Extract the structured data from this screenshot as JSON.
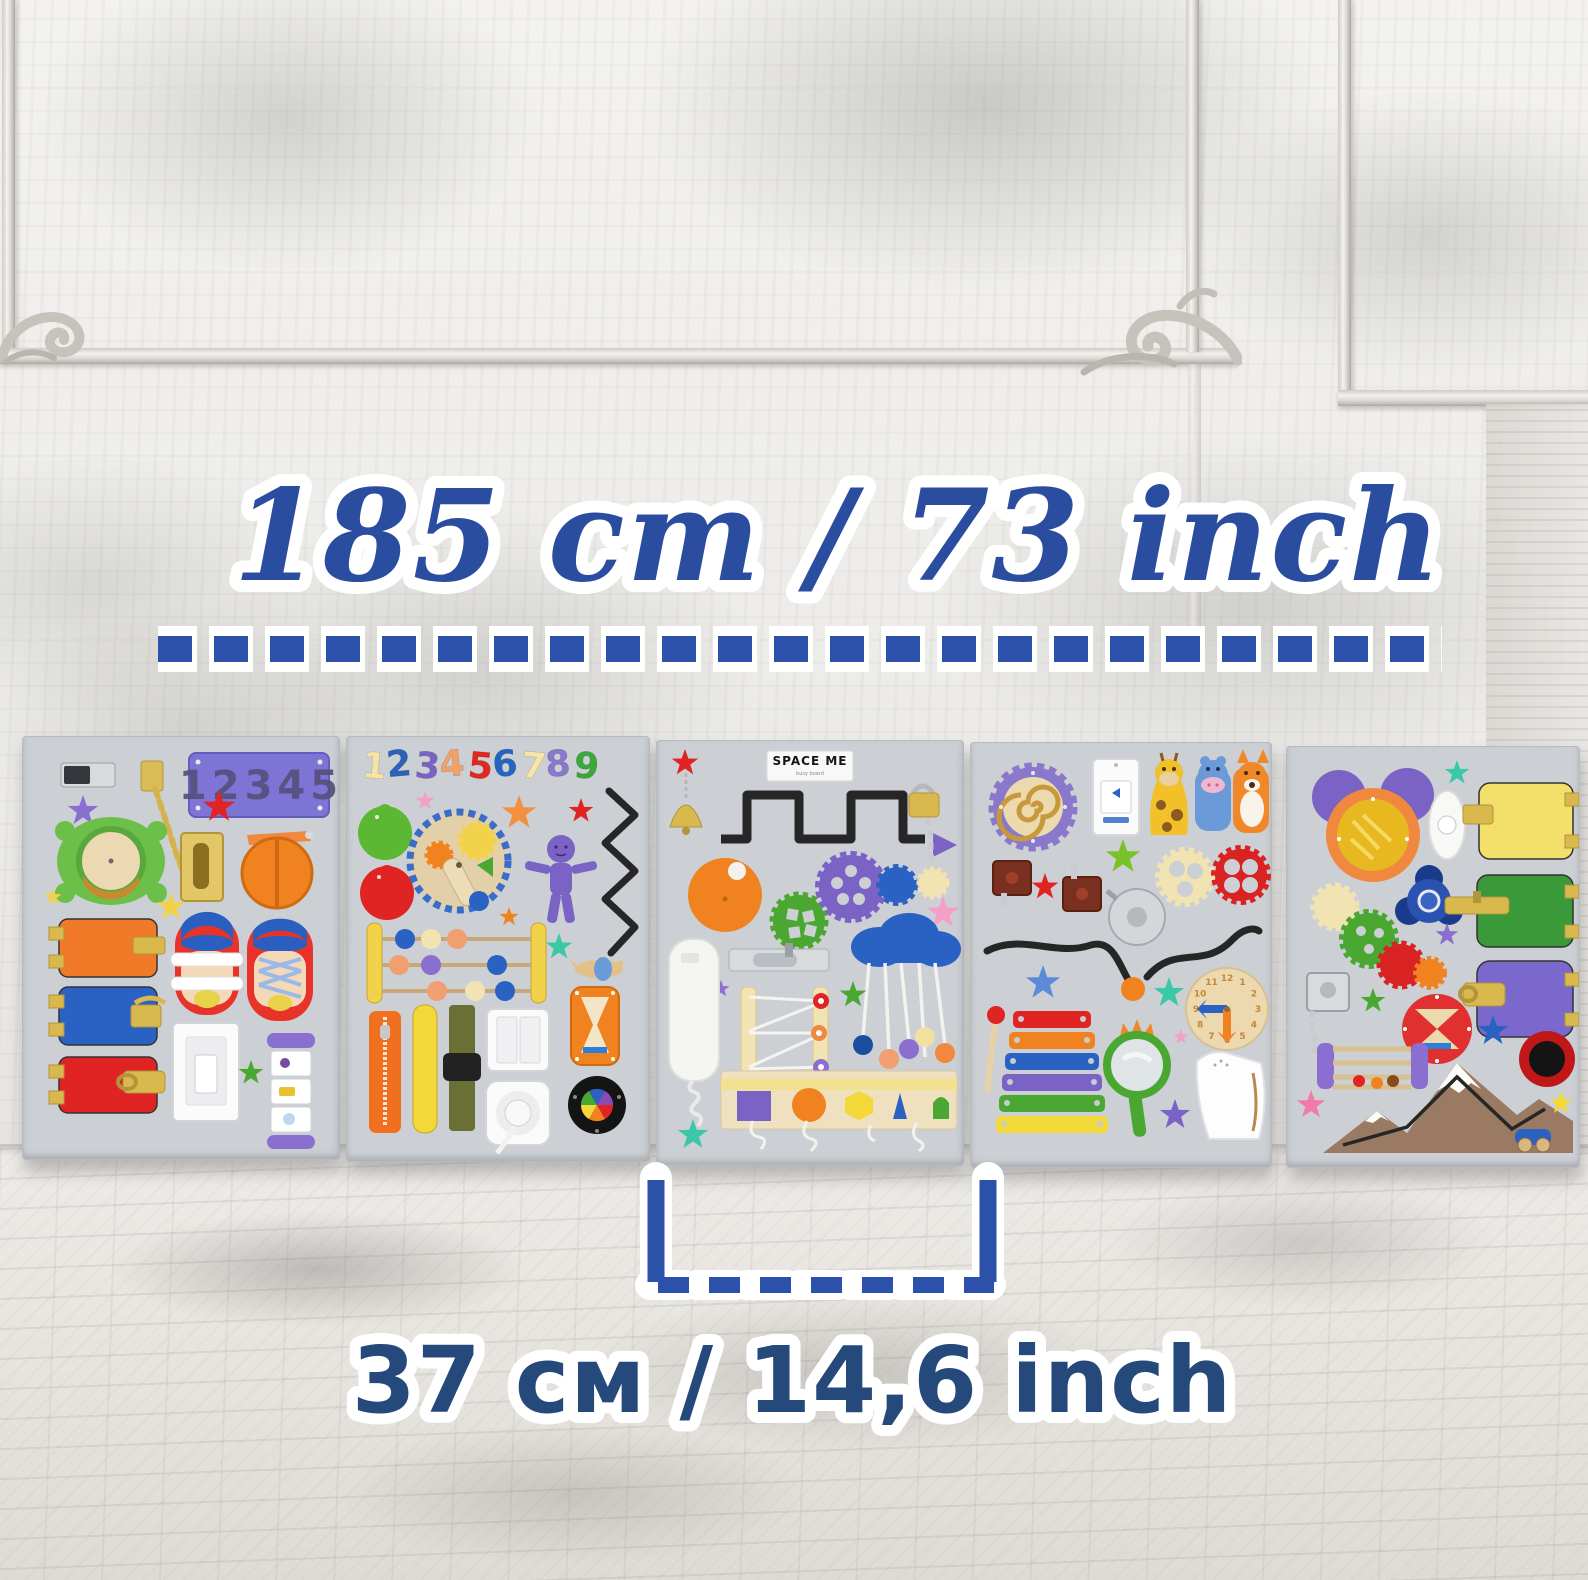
{
  "annotations": {
    "length_label": "185 cm  /  73 inch",
    "width_label": "37 см / 14,6 inch",
    "length_color": "#2b4da0",
    "width_color": "#26497c",
    "dash_color": "#2b51ab"
  },
  "palette": {
    "board_gray": "#ccd0d4",
    "wall_white": "#efeeec",
    "floor_wood": "#e7e4e0",
    "brass": "#d9b84e",
    "chrome": "#d8dadc"
  },
  "boards": [
    {
      "id": "board-1",
      "plaque_number": "12345",
      "items": [
        "chrome-slide-latch",
        "purple-star",
        "number-plaque",
        "door-chain-lock",
        "turtle-sand-window",
        "door-guard-latch",
        "orange-spinning-wheel",
        "yellow-stars",
        "orange-door-with-latch",
        "velcro-sandal",
        "lace-up-sneaker",
        "blue-door-with-hook",
        "red-door-with-hasp",
        "light-switch",
        "picture-cube-spinner",
        "green-star"
      ]
    },
    {
      "id": "board-2",
      "numbers": [
        {
          "glyph": "1",
          "color": "#f5e3a8"
        },
        {
          "glyph": "2",
          "color": "#2e62b8"
        },
        {
          "glyph": "3",
          "color": "#7a63c4"
        },
        {
          "glyph": "4",
          "color": "#f2a269"
        },
        {
          "glyph": "5",
          "color": "#e02820"
        },
        {
          "glyph": "6",
          "color": "#2565c0"
        },
        {
          "glyph": "7",
          "color": "#f5e6a8"
        },
        {
          "glyph": "8",
          "color": "#8a78cc"
        },
        {
          "glyph": "9",
          "color": "#3aa83a"
        }
      ],
      "items": [
        "wooden-numbers-row",
        "pink-star",
        "orange-star",
        "red-star",
        "green-pear-knob",
        "red-balloon-knob",
        "gear-clock",
        "purple-doll",
        "zigzag-track",
        "abacus-beads",
        "teal-star",
        "wooden-airplane",
        "hourglass",
        "zipper",
        "yellow-strap",
        "buckle-strap",
        "double-light-switch",
        "socket-with-plug",
        "color-wheel"
      ]
    },
    {
      "id": "board-3",
      "brand": "SPACE ME",
      "brand_subtitle": "busy board",
      "items": [
        "red-star",
        "brass-bell",
        "brand-label",
        "square-wave-track",
        "purple-triangle",
        "padlock-with-chain",
        "orange-disc",
        "green-gear",
        "purple-gear",
        "blue-gear",
        "cream-gear",
        "pink-star",
        "cloud-bead-mobile",
        "barrel-bolt",
        "phone-handset",
        "elastic-lacing-board",
        "green-star",
        "shape-sorting-panel",
        "teal-star"
      ]
    },
    {
      "id": "board-4",
      "clock_numbers": [
        "12",
        "1",
        "2",
        "3",
        "4",
        "5",
        "6",
        "7",
        "8",
        "9",
        "10",
        "11"
      ],
      "items": [
        "sequin-spiral-gear",
        "doorbell-button",
        "giraffe-finger-puppet",
        "hippo-finger-puppet",
        "fox-finger-puppet",
        "green-star",
        "cream-gear",
        "red-gear",
        "brown-latches",
        "red-star",
        "chrome-bell",
        "wavy-track-with-slider",
        "blue-star",
        "teal-star",
        "learning-clock",
        "xylophone-with-mallet",
        "crown-mirror",
        "pink-star",
        "purple-star",
        "night-light"
      ]
    },
    {
      "id": "board-5",
      "items": [
        "mickey-sequin-disc",
        "teal-star",
        "oval-doorbell",
        "yellow-door-with-latch",
        "fidget-spinner",
        "gear-train",
        "purple-star",
        "green-door-with-bolt",
        "purple-door-with-hasp",
        "lock-with-chain",
        "green-star",
        "hourglass-disc",
        "blue-star",
        "squeeze-horn",
        "bead-rattle-drum",
        "pink-star",
        "mountain-car-track",
        "yellow-star"
      ]
    }
  ]
}
